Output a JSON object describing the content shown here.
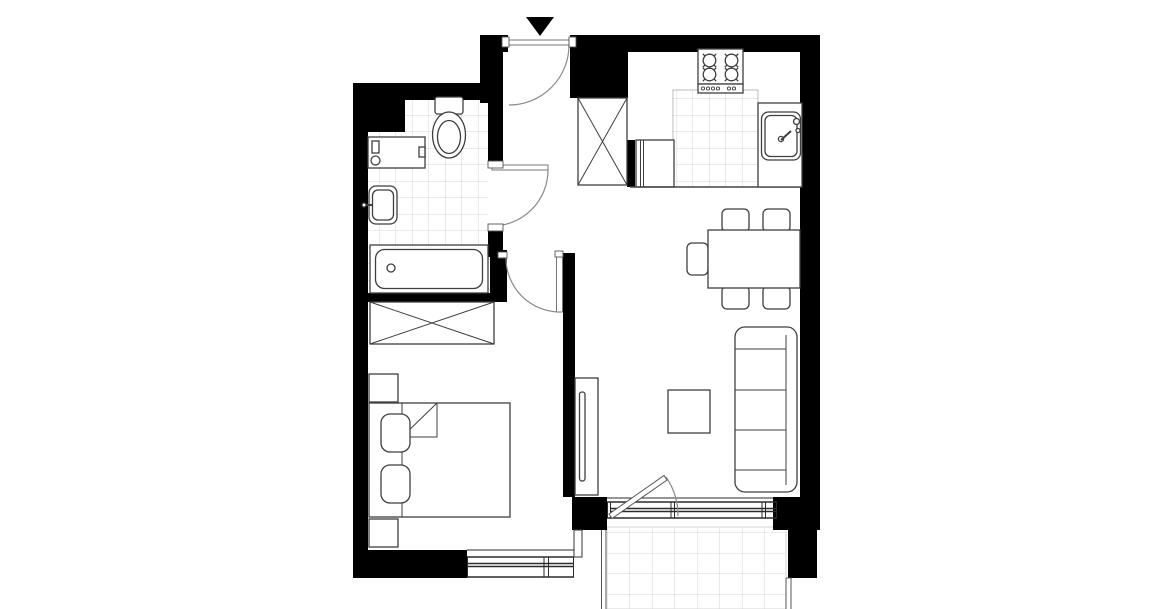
{
  "canvas": {
    "width": 1169,
    "height": 609,
    "background": "#ffffff"
  },
  "colors": {
    "wall": "#000000",
    "fixture_line": "#3f3f3f",
    "door_line": "#8a8a8a",
    "frame_line": "#555555",
    "tile_line": "#d6d6d6",
    "window_line": "#2b2b2b",
    "edge_line": "#555555",
    "counter_edge": "#444444",
    "white": "#ffffff"
  },
  "plan": {
    "type": "apartment-floor-plan",
    "visible_text": "none",
    "entrance_marker": "black triangle pointing down above entrance door",
    "rooms": [
      {
        "name": "bathroom",
        "floor": "tiled",
        "fixtures": [
          "toilet",
          "washing-machine",
          "washbasin",
          "bathtub"
        ]
      },
      {
        "name": "hallway",
        "fixtures": [
          "entrance-door",
          "bathroom-door",
          "bedroom-door"
        ]
      },
      {
        "name": "kitchen",
        "fixtures": [
          "crossed-wardrobe",
          "refrigerator",
          "stove-4-burners",
          "tiled-countertop",
          "kitchen-sink"
        ]
      },
      {
        "name": "living-dining-area",
        "fixtures": [
          "dining-table",
          "dining-chairs-x5",
          "sofa-3-seat",
          "coffee-table",
          "tv-cabinet",
          "balcony-door",
          "window"
        ]
      },
      {
        "name": "bedroom",
        "fixtures": [
          "double-bed",
          "pillows-x2",
          "nightstands-x2",
          "crossed-wardrobe",
          "window"
        ]
      },
      {
        "name": "balcony",
        "floor": "tiled"
      }
    ],
    "doors": [
      {
        "name": "entrance-door",
        "swing": "into-hallway"
      },
      {
        "name": "bathroom-door",
        "swing": "into-hallway"
      },
      {
        "name": "bedroom-door",
        "swing": "into-bedroom"
      },
      {
        "name": "balcony-door",
        "swing": "into-living-room"
      }
    ],
    "windows": [
      "bedroom-window",
      "living-room-window-with-balcony-door"
    ],
    "counts": {
      "dining_chairs": 5,
      "sofa_seats": 3,
      "stove_burners": 4,
      "pillows": 2,
      "nightstands": 2
    }
  }
}
